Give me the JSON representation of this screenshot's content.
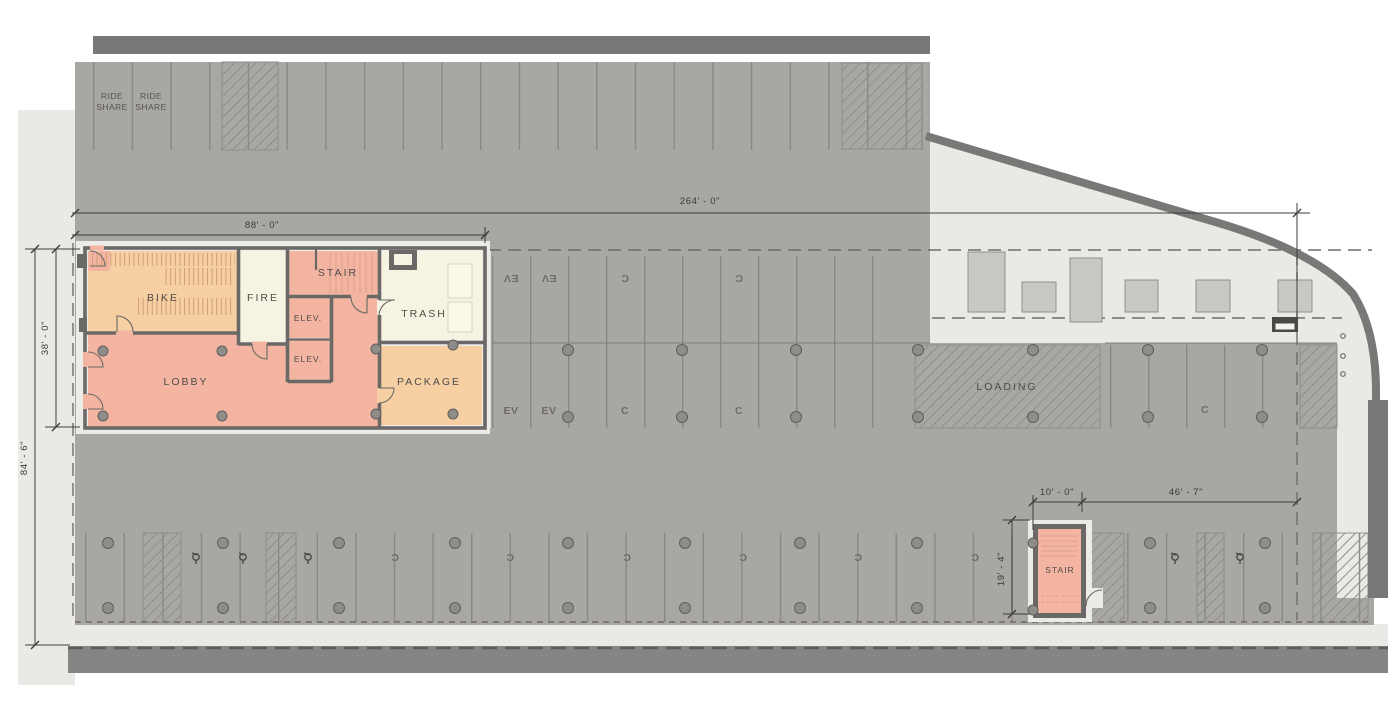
{
  "rooms": {
    "bike": "BIKE",
    "fire": "FIRE",
    "stair": "STAIR",
    "elevator": "ELEV.",
    "trash": "TRASH",
    "lobby": "LOBBY",
    "package": "PACKAGE",
    "stair_south": "STAIR",
    "loading": "LOADING"
  },
  "labels": {
    "ride_line1": "RIDE",
    "ride_line2": "SHARE",
    "ev": "EV",
    "compact": "C"
  },
  "dimensions": {
    "overall_length": "264' - 0\"",
    "core_length": "88' - 0\"",
    "core_depth": "38' - 0\"",
    "overall_depth": "84' - 6\"",
    "stair_south_width": "10' - 0\"",
    "stair_south_offset": "46' - 7\"",
    "stair_south_depth": "19' - 4\""
  },
  "colors": {
    "floor": "#a9a7a4",
    "sidewalk": "#eae9e6",
    "halo": "#ecebe8",
    "wall": "#7a7876",
    "wall_dark": "#6b6967",
    "band": "#868583",
    "salmon": "#f3b5a1",
    "orange": "#f6cfa2",
    "cream": "#f6f3e2",
    "column": "#8e8d8a",
    "fixture": "#c9c8c4"
  }
}
